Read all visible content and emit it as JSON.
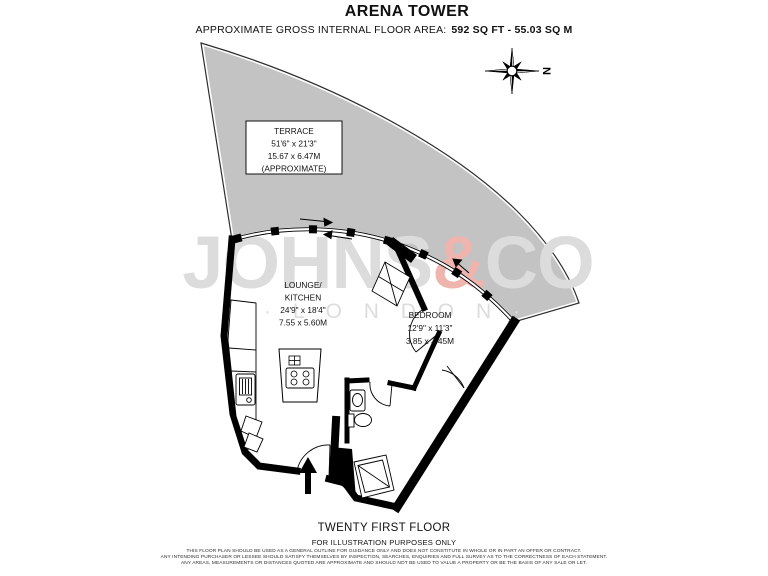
{
  "header": {
    "title": "ARENA TOWER",
    "area_label": "APPROXIMATE GROSS INTERNAL FLOOR AREA:",
    "area_value": "592 SQ FT - 55.03 SQ M"
  },
  "compass": {
    "north_label": "N"
  },
  "watermark": {
    "brand_part1": "JOHNS",
    "ampersand": "&",
    "brand_part2": "CO",
    "city_line": "· L O N D O N ·",
    "text_color": "#dcdcdc",
    "ampersand_color": "#f0b4ae"
  },
  "rooms": {
    "terrace": {
      "name": "TERRACE",
      "dims_imperial": "51'6\" x 21'3\"",
      "dims_metric": "15.67 x 6.47M",
      "note": "(APPROXIMATE)"
    },
    "lounge_kitchen": {
      "name_line1": "LOUNGE/",
      "name_line2": "KITCHEN",
      "dims_imperial": "24'9\" x 18'4\"",
      "dims_metric": "7.55 x 5.60M"
    },
    "bedroom": {
      "name": "BEDROOM",
      "dims_imperial": "12'9\" x 11'3\"",
      "dims_metric": "3.85 x 3.45M"
    }
  },
  "footer": {
    "floor_label": "TWENTY FIRST FLOOR",
    "illustration_note": "FOR ILLUSTRATION PURPOSES ONLY",
    "disclaimer_lines": [
      "THIS FLOOR PLAN SHOULD BE USED AS A GENERAL OUTLINE FOR GUIDANCE ONLY AND DOES NOT CONSTITUTE IN WHOLE OR IN PART AN OFFER OR CONTRACT.",
      "ANY INTENDING PURCHASER OR LESSEE SHOULD SATISFY THEMSELVES BY INSPECTION, SEARCHES, ENQUIRIES AND FULL SURVEY AS TO THE CORRECTNESS OF EACH STATEMENT.",
      "ANY AREAS, MEASUREMENTS OR DISTANCES QUOTED ARE APPROXIMATE AND SHOULD NOT BE USED TO VALUE A PROPERTY OR BE THE BASIS OF ANY SALE OR LET."
    ]
  },
  "colors": {
    "terrace_fill": "#c3c3c3",
    "wall": "#000000"
  }
}
